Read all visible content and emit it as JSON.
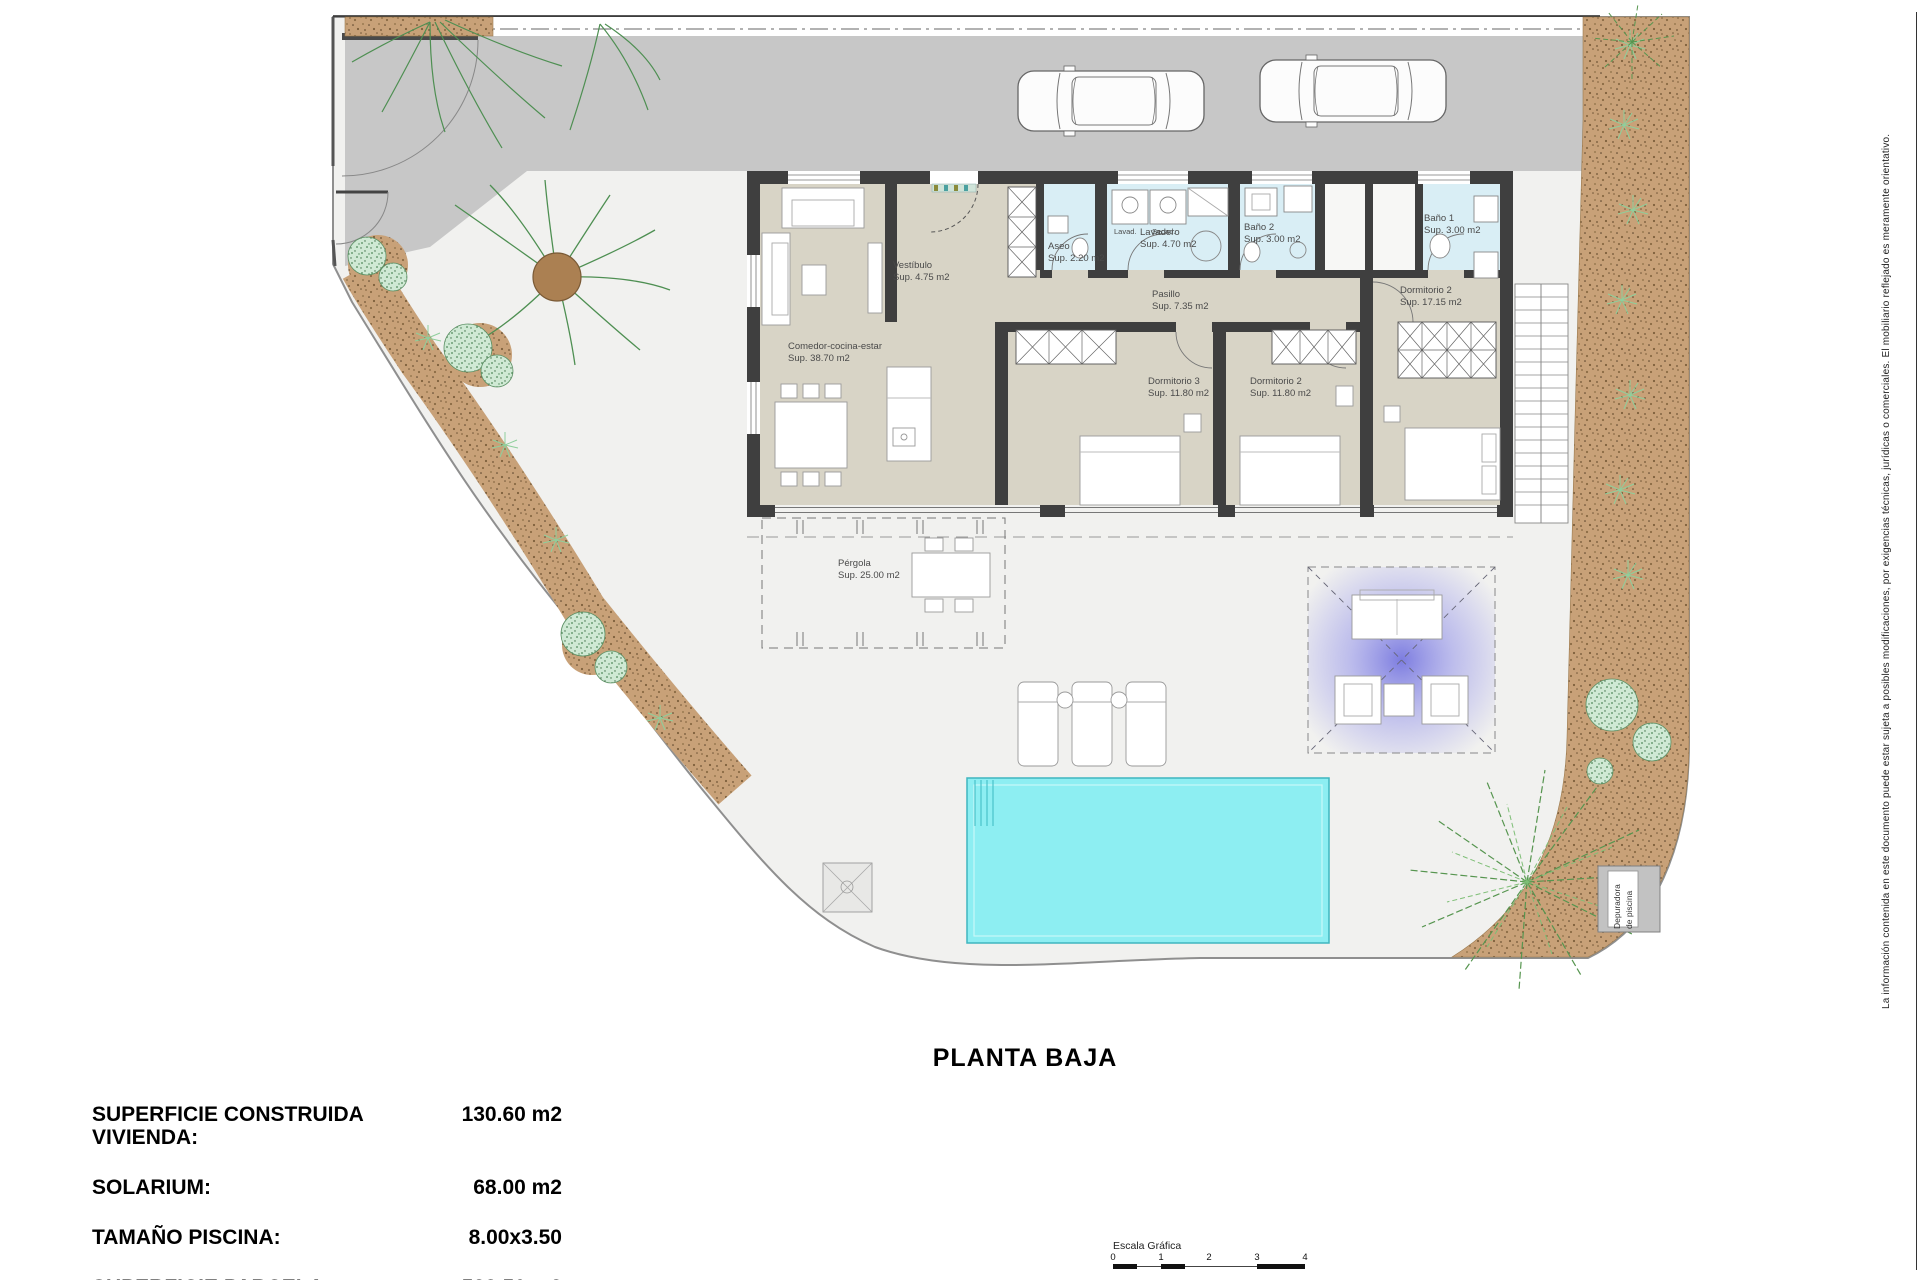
{
  "title": "PLANTA BAJA",
  "summary": {
    "rows": [
      {
        "label": "SUPERFICIE CONSTRUIDA VIVIENDA:",
        "value": "130.60 m2"
      },
      {
        "label": "SOLARIUM:",
        "value": "68.00 m2"
      },
      {
        "label": "TAMAÑO PISCINA:",
        "value": "8.00x3.50"
      },
      {
        "label": "SUPERFICIE PARCELA:",
        "value": "522.50 m2"
      }
    ]
  },
  "disclaimer": "La información contenida en este documento puede estar sujeta a posibles modificaciones, por exigencias técnicas, jurídicas o comerciales. El mobiliario reflejado es meramente orientativo.",
  "scale_bar": {
    "label": "Escala Gráfica",
    "ticks": [
      "0",
      "1",
      "2",
      "3",
      "4"
    ]
  },
  "rooms": {
    "comedor": {
      "name": "Comedor-cocina-estar",
      "sup": "Sup. 38.70 m2"
    },
    "vestibulo": {
      "name": "Vestíbulo",
      "sup": "Sup. 4.75 m2"
    },
    "aseo": {
      "name": "Aseo",
      "sup": "Sup. 2.20 m2"
    },
    "lavadero": {
      "name": "Lavadero",
      "sup": "Sup. 4.70 m2"
    },
    "bano2": {
      "name": "Baño 2",
      "sup": "Sup. 3.00 m2"
    },
    "bano1": {
      "name": "Baño 1",
      "sup": "Sup. 3.00 m2"
    },
    "pasillo": {
      "name": "Pasillo",
      "sup": "Sup. 7.35 m2"
    },
    "dorm3": {
      "name": "Dormitorio 3",
      "sup": "Sup. 11.80 m2"
    },
    "dorm2": {
      "name": "Dormitorio 2",
      "sup": "Sup. 11.80 m2"
    },
    "dorm1": {
      "name": "Dormitorio 2",
      "sup": "Sup. 17.15 m2"
    },
    "pergola": {
      "name": "Pérgola",
      "sup": "Sup. 25.00 m2"
    }
  },
  "appliances": {
    "washer": "Lavad.",
    "dryer": "Secad."
  },
  "equipment": {
    "pool_filter_line1": "Depuradora",
    "pool_filter_line2": "de piscina"
  },
  "colors": {
    "street": "#c7c7c7",
    "parcel": "#f1f1ef",
    "garden_soil": "#c8a178",
    "floor_beige": "#d8d4c6",
    "floor_wet": "#d9eef5",
    "wall": "#3f3f3f",
    "pool": "#8deef2",
    "chillout": "#7a7ae2",
    "foliage": "#5a9e5a"
  }
}
